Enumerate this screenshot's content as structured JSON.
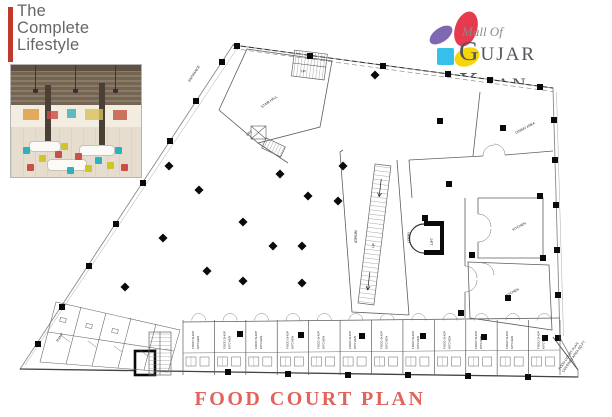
{
  "branding": {
    "tagline_lines": [
      "The",
      "Complete",
      "Lifestyle"
    ],
    "accent_color": "#c0392b",
    "text_color": "#666666"
  },
  "logo": {
    "script_text": "Mall Of",
    "name_text": "Gujar Khan",
    "colors": {
      "petal_red": "#e63a4f",
      "petal_purple": "#7e68b2",
      "petal_blue": "#35bfea",
      "petal_yellow": "#f6d60a",
      "name_gray": "#53535b",
      "script_gray": "#8a8a8a"
    }
  },
  "photo": {
    "description": "Food court interior rendering with wood-slat ceiling, white tables and teal, yellow and red chairs"
  },
  "plan_title": {
    "text": "FOOD COURT PLAN",
    "color": "#e2625c"
  },
  "plan": {
    "annotation_lines": [
      "FOOD COURT PLAN",
      "COVERED AREA SQ.FT."
    ],
    "labels": [
      {
        "x": 190,
        "y": 82,
        "r": -57,
        "t": "ENTRANCE"
      },
      {
        "x": 262,
        "y": 108,
        "r": -35,
        "t": "STAIR HALL"
      },
      {
        "x": 247,
        "y": 136,
        "r": -35,
        "t": "LIFT"
      },
      {
        "x": 516,
        "y": 134,
        "r": -28,
        "t": "DINING AREA"
      },
      {
        "x": 513,
        "y": 231,
        "r": -28,
        "t": "KITCHEN"
      },
      {
        "x": 506,
        "y": 297,
        "r": -28,
        "t": "KITCHEN"
      },
      {
        "x": 410,
        "y": 243,
        "r": -90,
        "t": "LOBBY"
      },
      {
        "x": 357,
        "y": 243,
        "r": -90,
        "t": "ATRIUM"
      },
      {
        "x": 374,
        "y": 248,
        "r": -81,
        "t": "UP"
      },
      {
        "x": 301,
        "y": 72,
        "r": 7,
        "t": "UP"
      },
      {
        "x": 58,
        "y": 342,
        "r": -57,
        "t": "RAMP"
      }
    ],
    "lift_label": "LIFT",
    "shops": {
      "count": 12,
      "label_line1": "FOOD SHOP",
      "label_line2": "KITCHEN"
    },
    "columns": {
      "squares": [
        [
          237,
          46
        ],
        [
          310,
          56
        ],
        [
          383,
          66
        ],
        [
          448,
          74
        ],
        [
          490,
          80
        ],
        [
          540,
          87
        ],
        [
          222,
          62
        ],
        [
          196,
          101
        ],
        [
          170,
          141
        ],
        [
          143,
          183
        ],
        [
          116,
          224
        ],
        [
          89,
          266
        ],
        [
          62,
          307
        ],
        [
          38,
          344
        ],
        [
          554,
          120
        ],
        [
          555,
          160
        ],
        [
          556,
          205
        ],
        [
          557,
          250
        ],
        [
          558,
          295
        ],
        [
          558,
          338
        ],
        [
          440,
          121
        ],
        [
          503,
          128
        ],
        [
          449,
          184
        ],
        [
          540,
          196
        ],
        [
          543,
          258
        ],
        [
          472,
          255
        ],
        [
          425,
          218
        ],
        [
          461,
          313
        ],
        [
          508,
          298
        ],
        [
          240,
          334
        ],
        [
          301,
          335
        ],
        [
          362,
          336
        ],
        [
          423,
          336
        ],
        [
          484,
          337
        ],
        [
          545,
          338
        ],
        [
          228,
          372
        ],
        [
          288,
          374
        ],
        [
          348,
          375
        ],
        [
          408,
          375
        ],
        [
          468,
          376
        ],
        [
          528,
          377
        ]
      ],
      "diamonds": [
        [
          169,
          166
        ],
        [
          199,
          190
        ],
        [
          280,
          174
        ],
        [
          308,
          196
        ],
        [
          338,
          201
        ],
        [
          243,
          222
        ],
        [
          163,
          238
        ],
        [
          273,
          246
        ],
        [
          302,
          246
        ],
        [
          207,
          271
        ],
        [
          243,
          281
        ],
        [
          302,
          283
        ],
        [
          125,
          287
        ],
        [
          343,
          166
        ],
        [
          375,
          75
        ]
      ]
    }
  }
}
